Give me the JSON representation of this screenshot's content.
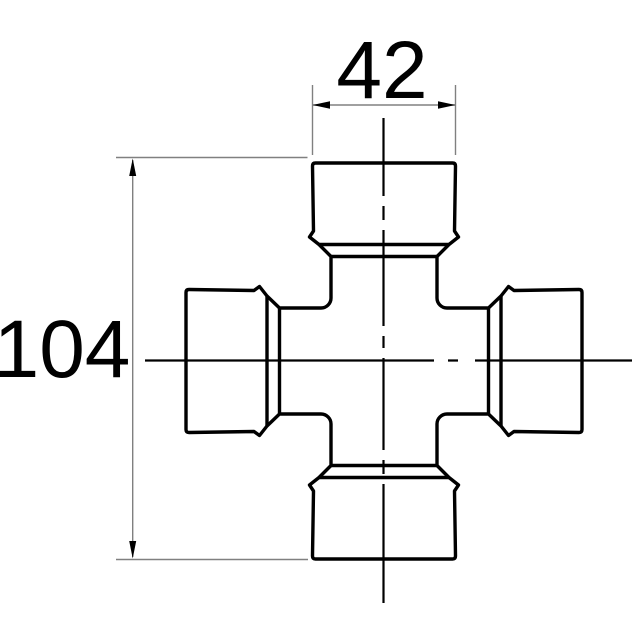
{
  "drawing": {
    "dimensions": {
      "width_label": "42",
      "length_label": "104"
    },
    "colors": {
      "background": "#ffffff",
      "part_outline": "#000000",
      "centerline": "#000000",
      "dimension_lines": "#808080",
      "arrowheads": "#000000",
      "text": "#000000"
    }
  }
}
